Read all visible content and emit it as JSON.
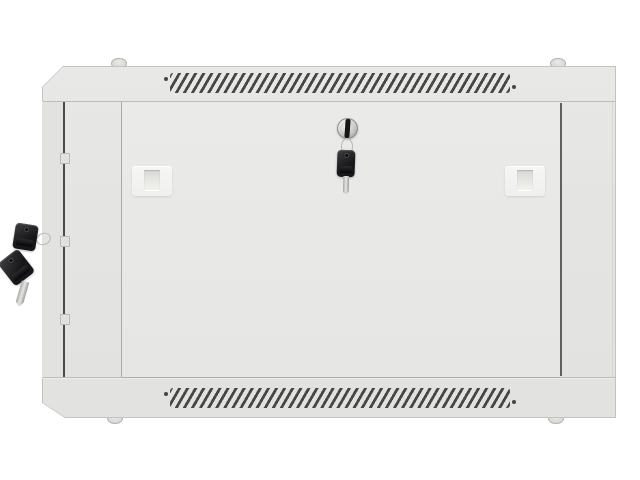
{
  "scene": {
    "type": "product-photo",
    "subject": "Light-gray wall-mount network rack cabinet, front view, closed solid metal door",
    "details": "Diagonal ventilation slot rows along the top and bottom rails, chrome cylinder lock in the upper middle of the door with one black key hanging from it on a ring, two spare black keys hanging from a hook on the left side panel, two pale latch plates on the door, four small mounting studs on the top and bottom edges, three hinge tabs along the left door gap"
  },
  "colors": {
    "bg": "#ffffff",
    "body": "#e4e4e2",
    "door": "#eaeae8",
    "side": "#e2e2e0",
    "outline": "#c3c3c1",
    "seam": "#bcbcba",
    "gapDark": "#4a4a48",
    "gapLeft": "#a9a9a7",
    "gapRight": "#606060",
    "ventSlot": "#474747",
    "latchPlate": "#f6f6f4",
    "latchRecess": "#d7d7d5",
    "chromeHi": "#fafafa",
    "chromeLo": "#9e9e9c",
    "slot": "#161616",
    "keyHead": "#17171a",
    "keyHeadHi": "#3e3e40",
    "blade": "#e6e6e4",
    "ring": "#b9b9b7",
    "stud": "#cfcfcd"
  },
  "parts": {
    "vent_grilles": {
      "rows": 2,
      "slots_per_row": 42,
      "slot_angle_deg": 60
    },
    "latch_plates": {
      "count": 2
    },
    "lock": {
      "type": "chrome-cylinder-lock",
      "keyhole": "vertical-slot"
    },
    "keys": {
      "total": 3,
      "on_door_lock": 1,
      "on_side_hook": 2
    },
    "hinge_tabs": {
      "count": 3
    },
    "mounting_studs": {
      "count": 4
    }
  }
}
